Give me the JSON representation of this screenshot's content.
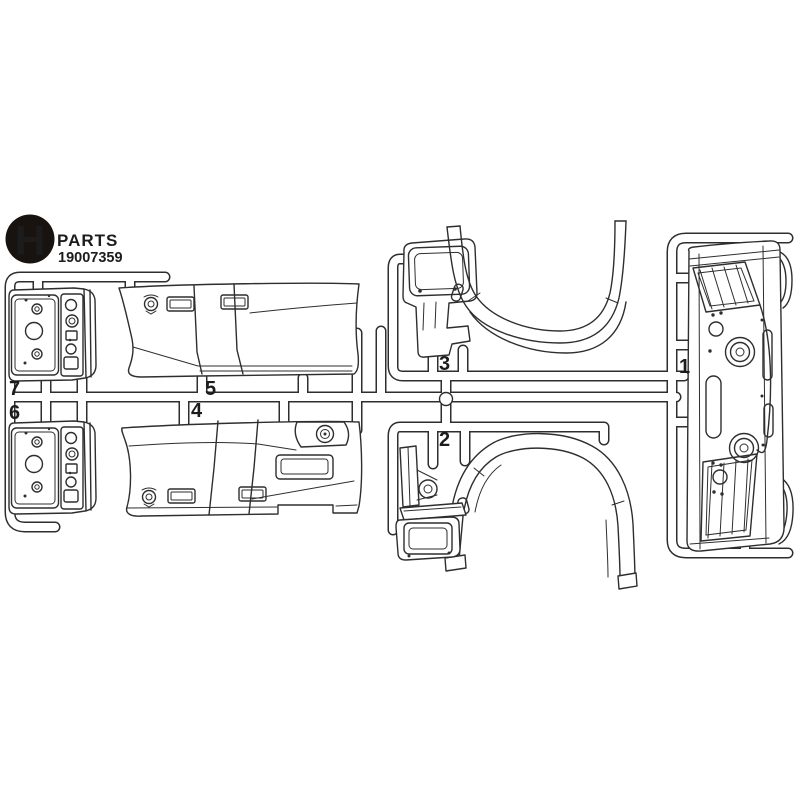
{
  "canvas": {
    "background": "#ffffff",
    "line_color": "#2e2e2e"
  },
  "header": {
    "sheet_letter": "H",
    "sheet_word": "PARTS",
    "item_code": "19007359",
    "badge_color": "#191310",
    "letter_color": "#ffffff"
  },
  "part_labels": [
    "1",
    "2",
    "3",
    "4",
    "5",
    "6",
    "7"
  ]
}
